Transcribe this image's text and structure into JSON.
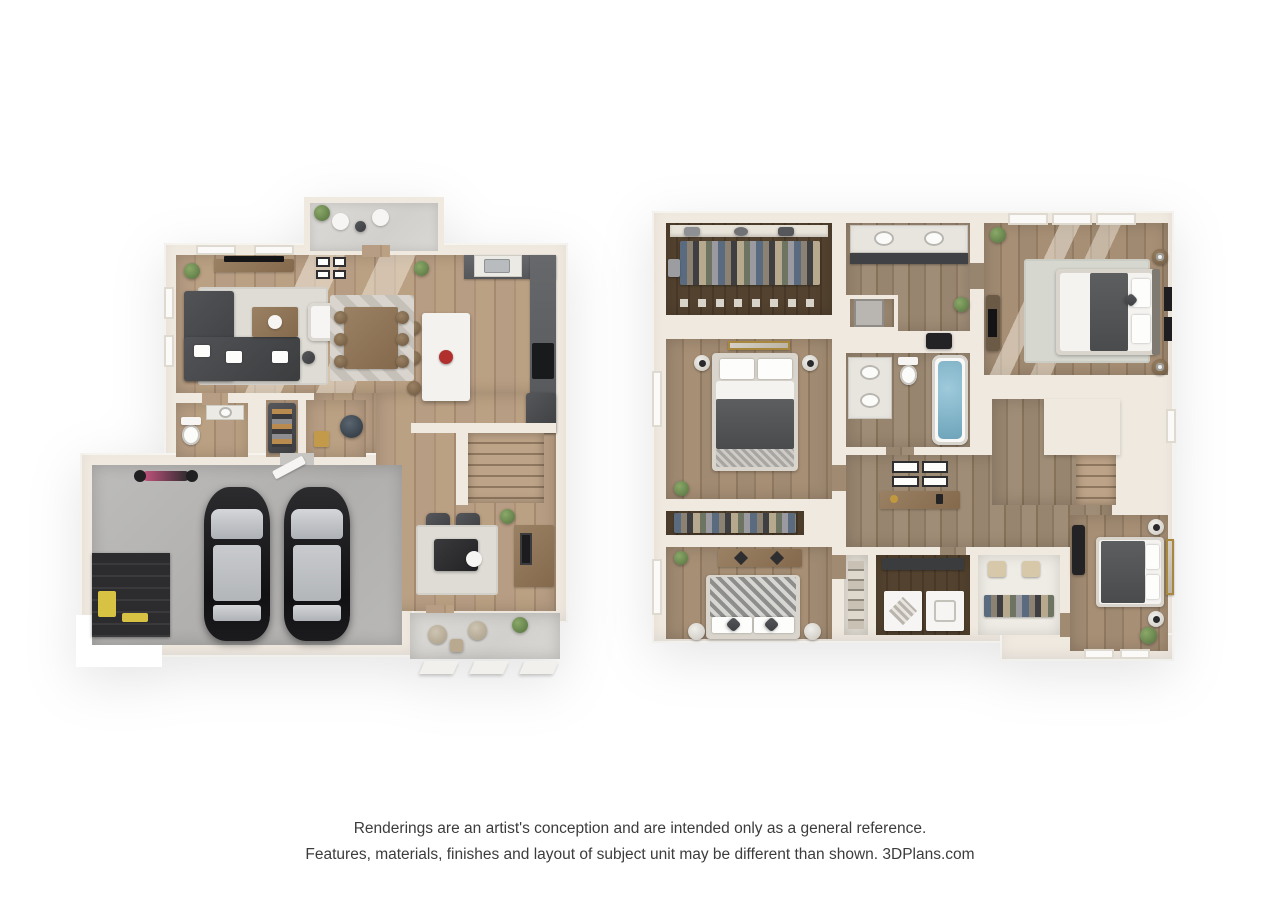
{
  "disclaimer": {
    "line1": "Renderings are an artist's conception and are intended only as a general reference.",
    "line2": "Features, materials, finishes and layout of subject unit may be different than shown. 3DPlans.com"
  },
  "palette": {
    "background": "#ffffff",
    "wall": "#efe9e0",
    "wall_shadow": "#d8d1c5",
    "wood_light": "#b49a80",
    "wood_mid": "#9b8569",
    "closet_wood": "#4e3e2c",
    "concrete_garage": "#b6b5b3",
    "concrete_porch": "#d8d6d2",
    "rug_light": "#dfdcd5",
    "sofa_dark": "#47494b",
    "cabinet_dark": "#5b5d60",
    "island_white": "#f3f2ef",
    "accent_red": "#b1302e",
    "car_black": "#17171a",
    "car_glass": "#c3c6c9",
    "tub_water": "#7fb0c5",
    "plant_green": "#6d8c55",
    "motorcycle_pink": "#c75380",
    "tool_yellow": "#d7c243",
    "text": "#3c3c3c"
  }
}
